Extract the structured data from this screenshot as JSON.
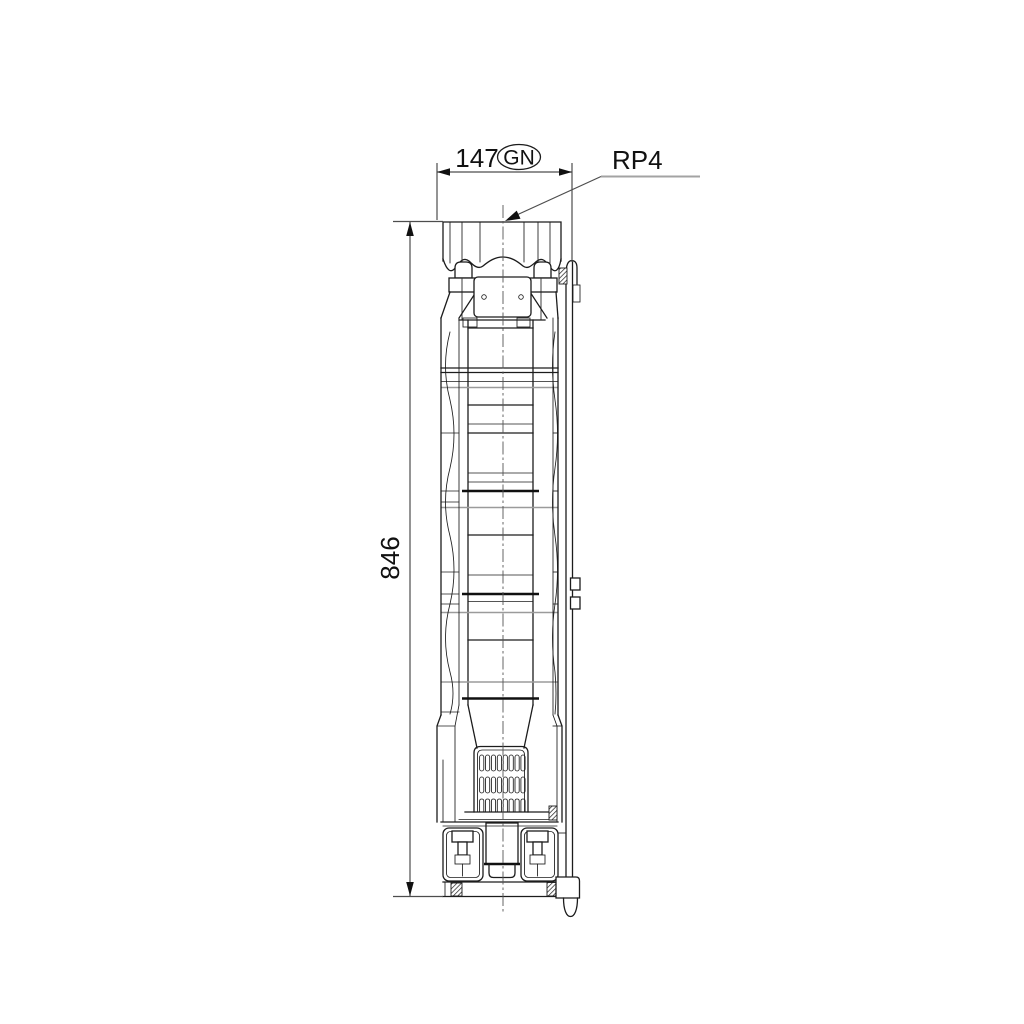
{
  "drawing": {
    "type": "technical-dimension-drawing",
    "subject": "submersible pump, side elevation",
    "labels": {
      "width_value": "147",
      "width_code": "GN",
      "connection": "RP4",
      "height_value": "846"
    },
    "dimensions": [
      {
        "name": "overall-width",
        "value": "147",
        "code": "GN",
        "orientation": "horizontal"
      },
      {
        "name": "overall-length",
        "value": "846",
        "orientation": "vertical"
      },
      {
        "name": "discharge-connection",
        "value": "RP4",
        "style": "leader-callout"
      }
    ],
    "colors": {
      "background": "#ffffff",
      "outline": "#1c1c1c",
      "dimension_line": "#4d4d4d",
      "secondary_line": "#9b9b9b"
    }
  }
}
